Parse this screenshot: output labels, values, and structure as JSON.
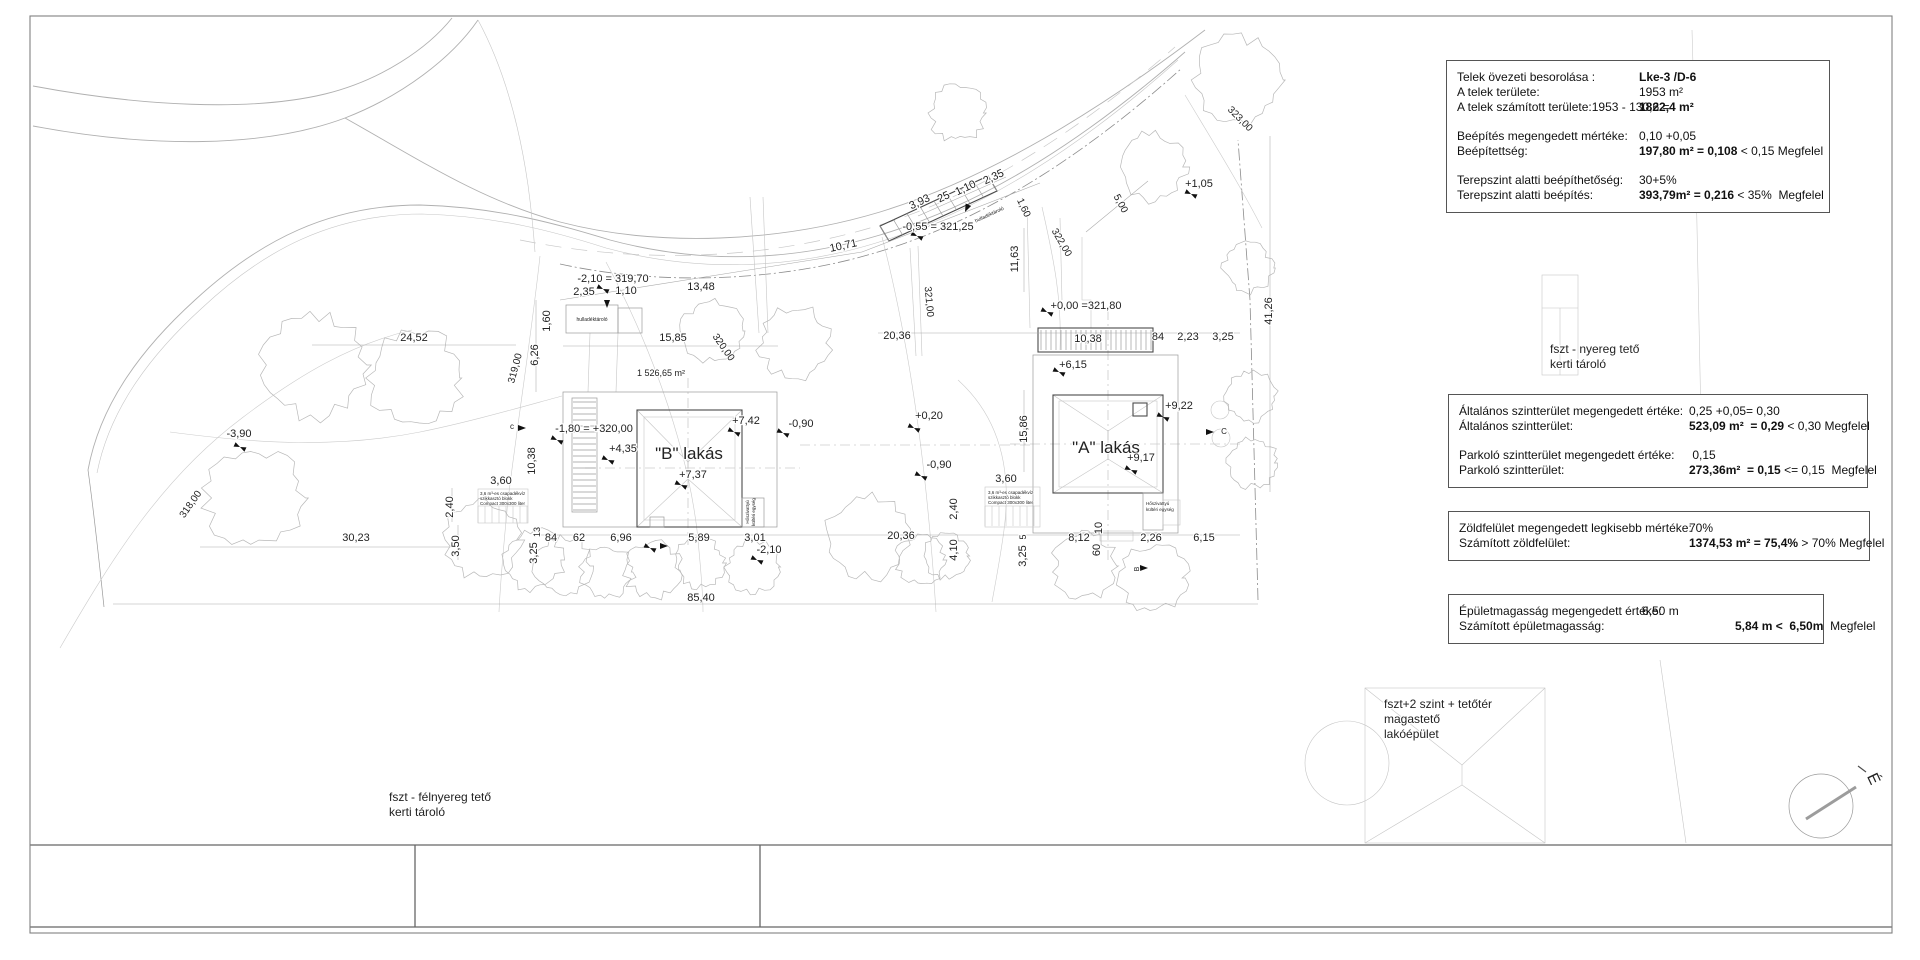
{
  "panels": {
    "zoning": {
      "rows": [
        {
          "l": "Telek övezeti besorolása :",
          "b": "Lke-3 /D-6",
          "r": ""
        },
        {
          "l": "A telek területe:",
          "b": "",
          "r": "1953 m²"
        },
        {
          "l": "A telek számított területe:1953 - 130,6 =",
          "b": "1822,4 m²",
          "r": ""
        },
        {
          "l": "Beépítés megengedett mértéke:",
          "b": "",
          "r": "0,10 +0,05"
        },
        {
          "l": "Beépítettség:",
          "b": "197,80 m² = 0,108",
          "r": " < 0,15 Megfelel"
        },
        {
          "l": "Terepszint alatti beépíthetőség:",
          "b": "",
          "r": "30+5%"
        },
        {
          "l": "Terepszint alatti beépítés:",
          "b": "393,79m² = 0,216",
          "r": " < 35%  Megfelel"
        }
      ]
    },
    "floor_area": {
      "rows": [
        {
          "l": "Általános szintterület megengedett értéke:",
          "b": "",
          "r": "0,25 +0,05= 0,30"
        },
        {
          "l": "Általános szintterület:",
          "b": "523,09 m²  = 0,29",
          "r": " < 0,30 Megfelel"
        },
        {
          "l": "Parkoló szintterület megengedett értéke:",
          "b": "",
          "r": " 0,15"
        },
        {
          "l": "Parkoló szintterület:",
          "b": "273,36m²  = 0,15",
          "r": " <= 0,15  Megfelel"
        }
      ]
    },
    "green": {
      "rows": [
        {
          "l": "Zöldfelület megengedett legkisebb mértéke:",
          "b": "",
          "r": "70%"
        },
        {
          "l": "Számított zöldfelület:",
          "b": "1374,53 m² = 75,4%",
          "r": " > 70% Megfelel"
        }
      ]
    },
    "height": {
      "rows": [
        {
          "l": "Épületmagasság megengedett értéke:",
          "b": "",
          "r": "6,50 m"
        },
        {
          "l": "Számított épületmagasság:",
          "b": "5,84 m <  6,50m",
          "r": "  Megfelel"
        }
      ]
    }
  },
  "plan_labels": [
    {
      "t": "-2,10 = 319,70",
      "x": 613,
      "y": 282,
      "r": 0,
      "s": 11
    },
    {
      "t": "2,35",
      "x": 584,
      "y": 295,
      "r": 0,
      "s": 11
    },
    {
      "t": "1,10",
      "x": 626,
      "y": 294,
      "r": 0,
      "s": 11
    },
    {
      "t": "13,48",
      "x": 701,
      "y": 290,
      "r": 0,
      "s": 11
    },
    {
      "t": "10,71",
      "x": 844,
      "y": 249,
      "r": -12,
      "s": 11
    },
    {
      "t": "3,93",
      "x": 921,
      "y": 205,
      "r": -25,
      "s": 11
    },
    {
      "t": "25",
      "x": 945,
      "y": 200,
      "r": -25,
      "s": 11
    },
    {
      "t": "1,10",
      "x": 967,
      "y": 191,
      "r": -25,
      "s": 11
    },
    {
      "t": "2,35",
      "x": 995,
      "y": 180,
      "r": -25,
      "s": 11
    },
    {
      "t": "1,60",
      "x": 1021,
      "y": 209,
      "r": 65,
      "s": 10
    },
    {
      "t": "-0,55 = 321,25",
      "x": 938,
      "y": 230,
      "r": 0,
      "s": 11
    },
    {
      "t": "11,63",
      "x": 1018,
      "y": 259,
      "r": -90,
      "s": 11
    },
    {
      "t": "5,00",
      "x": 1118,
      "y": 205,
      "r": 62,
      "s": 10
    },
    {
      "t": "+1,05",
      "x": 1199,
      "y": 187,
      "r": 0,
      "s": 11
    },
    {
      "t": "322,00",
      "x": 1059,
      "y": 244,
      "r": 60,
      "s": 10
    },
    {
      "t": "321,00",
      "x": 926,
      "y": 302,
      "r": 85,
      "s": 10
    },
    {
      "t": "320,00",
      "x": 721,
      "y": 349,
      "r": 55,
      "s": 10
    },
    {
      "t": "319,00",
      "x": 518,
      "y": 369,
      "r": -75,
      "s": 10
    },
    {
      "t": "318,00",
      "x": 193,
      "y": 506,
      "r": -55,
      "s": 10
    },
    {
      "t": "323,00",
      "x": 1238,
      "y": 121,
      "r": 45,
      "s": 10
    },
    {
      "t": "+0,00 =321,80",
      "x": 1086,
      "y": 309,
      "r": 0,
      "s": 11
    },
    {
      "t": "20,36",
      "x": 897,
      "y": 339,
      "r": 0,
      "s": 11
    },
    {
      "t": "10,38",
      "x": 1088,
      "y": 342,
      "r": 0,
      "s": 11
    },
    {
      "t": "84",
      "x": 1158,
      "y": 340,
      "r": 0,
      "s": 11
    },
    {
      "t": "2,23",
      "x": 1188,
      "y": 340,
      "r": 0,
      "s": 11
    },
    {
      "t": "3,25",
      "x": 1223,
      "y": 340,
      "r": 0,
      "s": 11
    },
    {
      "t": "+6,15",
      "x": 1073,
      "y": 368,
      "r": 0,
      "s": 11
    },
    {
      "t": "41,26",
      "x": 1272,
      "y": 311,
      "r": -90,
      "s": 11
    },
    {
      "t": "+9,22",
      "x": 1179,
      "y": 409,
      "r": 0,
      "s": 11
    },
    {
      "t": "\"A\" lakás",
      "x": 1106,
      "y": 453,
      "r": 0,
      "s": 17,
      "n": "house-a-label"
    },
    {
      "t": "+9,17",
      "x": 1141,
      "y": 461,
      "r": 0,
      "s": 11
    },
    {
      "t": "15,86",
      "x": 1027,
      "y": 429,
      "r": -90,
      "s": 11
    },
    {
      "t": "\"B\" lakás",
      "x": 689,
      "y": 459,
      "r": 0,
      "s": 17,
      "n": "house-b-label"
    },
    {
      "t": "+7,42",
      "x": 746,
      "y": 424,
      "r": 0,
      "s": 11
    },
    {
      "t": "+7,37",
      "x": 693,
      "y": 478,
      "r": 0,
      "s": 11
    },
    {
      "t": "+4,35",
      "x": 623,
      "y": 452,
      "r": 0,
      "s": 11
    },
    {
      "t": "-1,80 = +320,00",
      "x": 594,
      "y": 432,
      "r": 0,
      "s": 11
    },
    {
      "t": "1 526,65 m²",
      "x": 661,
      "y": 376,
      "r": 0,
      "s": 9
    },
    {
      "t": "-0,90",
      "x": 801,
      "y": 427,
      "r": 0,
      "s": 11
    },
    {
      "t": "+0,20",
      "x": 929,
      "y": 419,
      "r": 0,
      "s": 11
    },
    {
      "t": "-0,90",
      "x": 939,
      "y": 468,
      "r": 0,
      "s": 11
    },
    {
      "t": "24,52",
      "x": 414,
      "y": 341,
      "r": 0,
      "s": 11
    },
    {
      "t": "6,26",
      "x": 538,
      "y": 355,
      "r": -90,
      "s": 11
    },
    {
      "t": "1,60",
      "x": 550,
      "y": 321,
      "r": -90,
      "s": 11
    },
    {
      "t": "15,85",
      "x": 673,
      "y": 341,
      "r": 0,
      "s": 11
    },
    {
      "t": "-3,90",
      "x": 239,
      "y": 437,
      "r": 0,
      "s": 11
    },
    {
      "t": "30,23",
      "x": 356,
      "y": 541,
      "r": 0,
      "s": 11
    },
    {
      "t": "85,40",
      "x": 701,
      "y": 601,
      "r": 0,
      "s": 11
    },
    {
      "t": "3,50",
      "x": 459,
      "y": 546,
      "r": -90,
      "s": 11
    },
    {
      "t": "2,40",
      "x": 453,
      "y": 507,
      "r": -90,
      "s": 11
    },
    {
      "t": "10,38",
      "x": 535,
      "y": 461,
      "r": -90,
      "s": 11
    },
    {
      "t": "3,25",
      "x": 537,
      "y": 553,
      "r": -90,
      "s": 11
    },
    {
      "t": "13",
      "x": 540,
      "y": 532,
      "r": -90,
      "s": 9
    },
    {
      "t": "84",
      "x": 551,
      "y": 541,
      "r": 0,
      "s": 11
    },
    {
      "t": "62",
      "x": 579,
      "y": 541,
      "r": 0,
      "s": 11
    },
    {
      "t": "6,96",
      "x": 621,
      "y": 541,
      "r": 0,
      "s": 11
    },
    {
      "t": "5,89",
      "x": 699,
      "y": 541,
      "r": 0,
      "s": 11
    },
    {
      "t": "3,01",
      "x": 755,
      "y": 541,
      "r": 0,
      "s": 11
    },
    {
      "t": "-2,10",
      "x": 769,
      "y": 553,
      "r": 0,
      "s": 11
    },
    {
      "t": "3,60",
      "x": 501,
      "y": 484,
      "r": 0,
      "s": 11
    },
    {
      "t": "3,60",
      "x": 1006,
      "y": 482,
      "r": 0,
      "s": 11
    },
    {
      "t": "2,40",
      "x": 957,
      "y": 509,
      "r": -90,
      "s": 11
    },
    {
      "t": "4,10",
      "x": 957,
      "y": 550,
      "r": -90,
      "s": 11
    },
    {
      "t": "20,36",
      "x": 901,
      "y": 539,
      "r": 0,
      "s": 11
    },
    {
      "t": "5",
      "x": 1026,
      "y": 537,
      "r": -90,
      "s": 9
    },
    {
      "t": "3,25",
      "x": 1026,
      "y": 556,
      "r": -90,
      "s": 11
    },
    {
      "t": "8,12",
      "x": 1079,
      "y": 541,
      "r": 0,
      "s": 11
    },
    {
      "t": "60",
      "x": 1100,
      "y": 550,
      "r": -90,
      "s": 11
    },
    {
      "t": "10",
      "x": 1102,
      "y": 528,
      "r": -90,
      "s": 11
    },
    {
      "t": "2,26",
      "x": 1151,
      "y": 541,
      "r": 0,
      "s": 11
    },
    {
      "t": "6,15",
      "x": 1204,
      "y": 541,
      "r": 0,
      "s": 11
    },
    {
      "t": "c",
      "x": 512,
      "y": 429,
      "r": 0,
      "s": 8
    },
    {
      "t": "C",
      "x": 1224,
      "y": 434,
      "r": 0,
      "s": 8
    },
    {
      "t": "B",
      "x": 1139,
      "y": 569,
      "r": -90,
      "s": 7
    },
    {
      "t": "hulladéktároló",
      "x": 592,
      "y": 321,
      "r": 0,
      "s": 5
    },
    {
      "t": "hulladéktároló",
      "x": 990,
      "y": 216,
      "r": -25,
      "s": 5
    },
    {
      "t": "Hőszivattyú",
      "x": 749,
      "y": 512,
      "r": -90,
      "s": 4.5
    },
    {
      "t": "kültéri egység",
      "x": 755,
      "y": 512,
      "r": -90,
      "s": 4.5
    },
    {
      "t": "Hőszivattyú",
      "x": 1146,
      "y": 505,
      "r": 0,
      "s": 4.5,
      "a": "s"
    },
    {
      "t": "kültéri egység",
      "x": 1146,
      "y": 511,
      "r": 0,
      "s": 4.5,
      "a": "s"
    },
    {
      "t": "3,6 m³-es csapadékvíz",
      "x": 480,
      "y": 495,
      "r": 0,
      "s": 4.5,
      "a": "s"
    },
    {
      "t": "szikkasztó blokk",
      "x": 480,
      "y": 500,
      "r": 0,
      "s": 4.5,
      "a": "s"
    },
    {
      "t": "Compact 300x300 liter",
      "x": 480,
      "y": 505,
      "r": 0,
      "s": 4.5,
      "a": "s"
    },
    {
      "t": "3,6 m³-es csapadékvíz",
      "x": 988,
      "y": 494,
      "r": 0,
      "s": 4.5,
      "a": "s"
    },
    {
      "t": "szikkasztó blokk",
      "x": 988,
      "y": 499,
      "r": 0,
      "s": 4.5,
      "a": "s"
    },
    {
      "t": "Compact 300x300 liter",
      "x": 988,
      "y": 504,
      "r": 0,
      "s": 4.5,
      "a": "s"
    },
    {
      "t": "fszt - nyereg tető",
      "x": 1550,
      "y": 353,
      "r": 0,
      "s": 12,
      "a": "s",
      "n": "note-shed-right"
    },
    {
      "t": "kerti tároló",
      "x": 1550,
      "y": 368,
      "r": 0,
      "s": 12,
      "a": "s",
      "n": "note-shed-right"
    },
    {
      "t": "fszt+2 szint + tetőtér",
      "x": 1384,
      "y": 708,
      "r": 0,
      "s": 12,
      "a": "s",
      "n": "note-main-building"
    },
    {
      "t": "magastető",
      "x": 1384,
      "y": 723,
      "r": 0,
      "s": 12,
      "a": "s",
      "n": "note-main-building"
    },
    {
      "t": "lakóépület",
      "x": 1384,
      "y": 738,
      "r": 0,
      "s": 12,
      "a": "s",
      "n": "note-main-building"
    },
    {
      "t": "fszt - félnyereg tető",
      "x": 389,
      "y": 801,
      "r": 0,
      "s": 12,
      "a": "s",
      "n": "note-shed-left"
    },
    {
      "t": "kerti tároló",
      "x": 389,
      "y": 816,
      "r": 0,
      "s": 12,
      "a": "s",
      "n": "note-shed-left"
    },
    {
      "t": "É",
      "x": 1869,
      "y": 781,
      "r": 65,
      "s": 16,
      "n": "north-label"
    }
  ]
}
